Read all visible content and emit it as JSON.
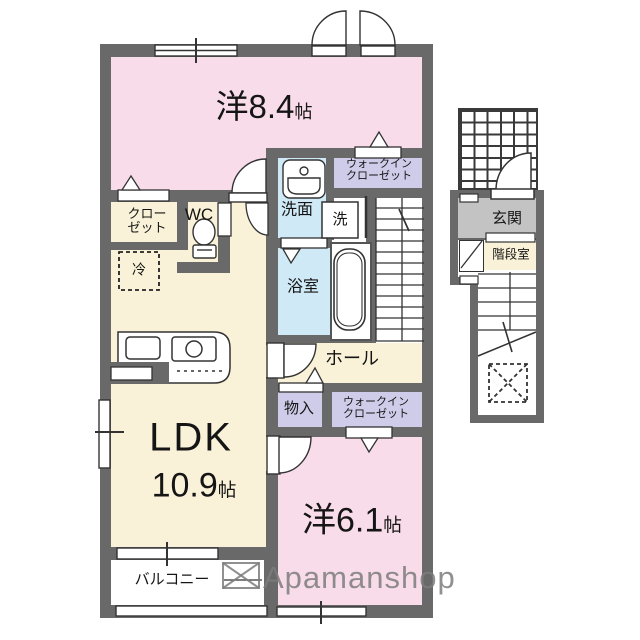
{
  "colors": {
    "wall": "#696969",
    "room_pink": "#f9dcea",
    "room_cream": "#f9f2d8",
    "closet_lavender": "#cfcce9",
    "wet_blue": "#cfe9f6",
    "genkan_gray": "#c3c3c3",
    "watermark_gray": "#7d7d7d"
  },
  "rooms": {
    "yo84": {
      "name": "洋8.4",
      "unit": "帖"
    },
    "wic1": {
      "line1": "ウォークイン",
      "line2": "クローゼット"
    },
    "closet": {
      "line1": "クロー",
      "line2": "ゼット"
    },
    "wc": {
      "label": "WC"
    },
    "fridge": {
      "label": "冷"
    },
    "senmen": {
      "label": "洗面"
    },
    "washer": {
      "label": "洗"
    },
    "bath": {
      "label": "浴室"
    },
    "hall": {
      "label": "ホール"
    },
    "monoire": {
      "label": "物入"
    },
    "wic2": {
      "line1": "ウォークイン",
      "line2": "クローゼット"
    },
    "ldk": {
      "name": "LDK",
      "size": "10.9",
      "unit": "帖"
    },
    "yo61": {
      "name": "洋6.1",
      "unit": "帖"
    },
    "balcony": {
      "label": "バルコニー"
    },
    "genkan": {
      "label": "玄関"
    },
    "kaidanshitsu": {
      "label": "階段室"
    }
  },
  "watermark": {
    "brand": "Apamanshop"
  }
}
